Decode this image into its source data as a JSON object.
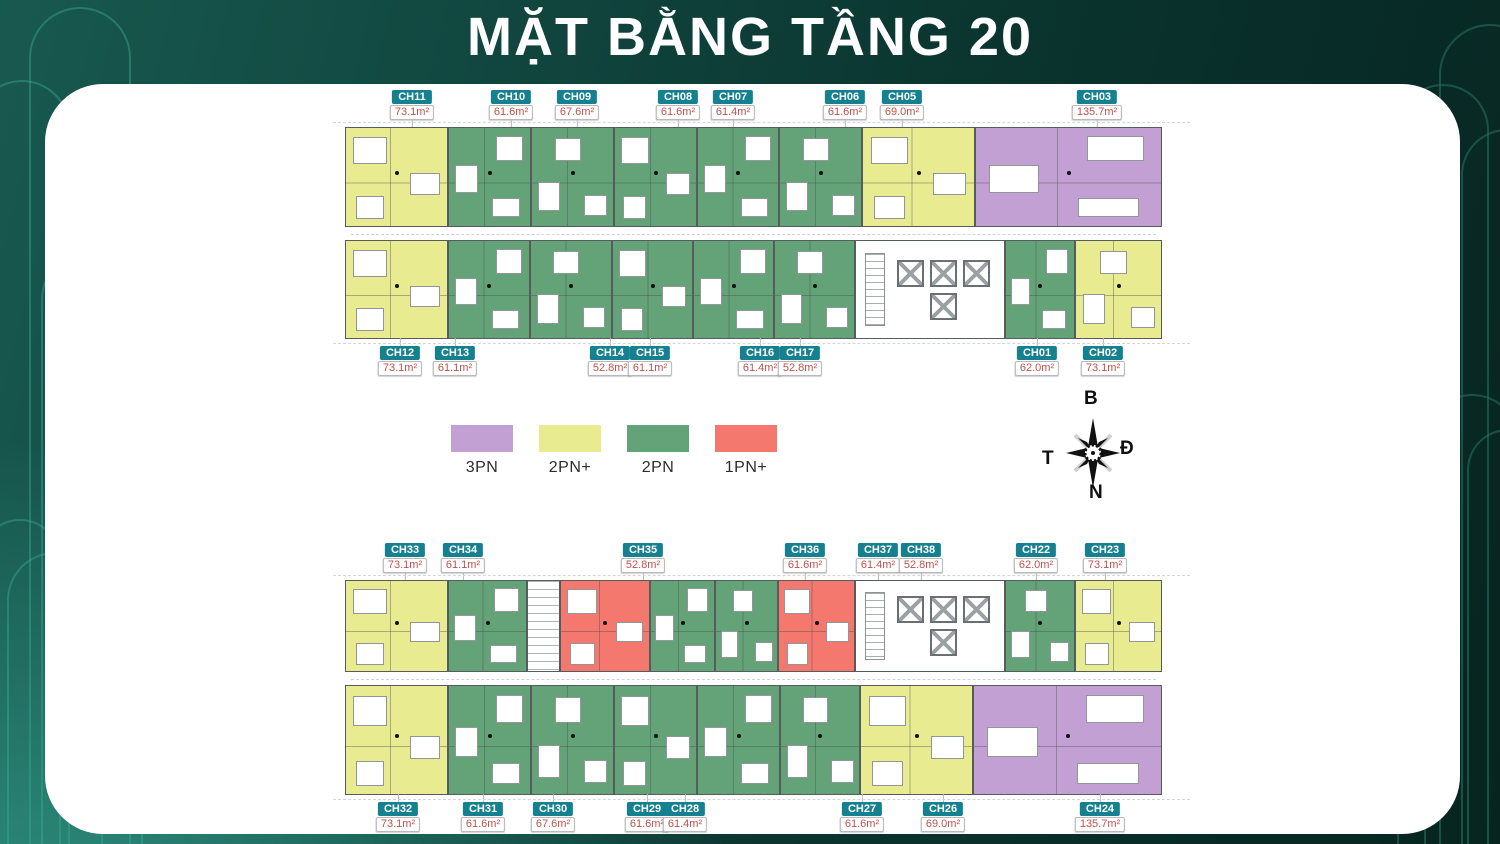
{
  "title": "MẶT BẰNG TẦNG 20",
  "legend": {
    "items": [
      {
        "label": "3PN",
        "type": "3PN"
      },
      {
        "label": "2PN+",
        "type": "2PN+"
      },
      {
        "label": "2PN",
        "type": "2PN"
      },
      {
        "label": "1PN+",
        "type": "1PN+"
      }
    ]
  },
  "compass": {
    "north_label": "B",
    "east_label": "Đ",
    "south_label": "N",
    "west_label": "T"
  },
  "unit_types": {
    "3PN": "#c3a0d4",
    "2PN+": "#e9eb90",
    "2PN": "#63a377",
    "1PN+": "#f5786e"
  },
  "plans": [
    {
      "name": "top-wing",
      "left": 345,
      "top": 88,
      "width": 817,
      "label_zone_h": 39,
      "row_heights": [
        100,
        99
      ],
      "corridor_h": 13,
      "labels_above": [
        {
          "id": "CH11",
          "area": "73.1m²",
          "x": 412
        },
        {
          "id": "CH10",
          "area": "61.6m²",
          "x": 511
        },
        {
          "id": "CH09",
          "area": "67.6m²",
          "x": 577
        },
        {
          "id": "CH08",
          "area": "61.6m²",
          "x": 678
        },
        {
          "id": "CH07",
          "area": "61.4m²",
          "x": 733
        },
        {
          "id": "CH06",
          "area": "61.6m²",
          "x": 845
        },
        {
          "id": "CH05",
          "area": "69.0m²",
          "x": 902
        },
        {
          "id": "CH03",
          "area": "135.7m²",
          "x": 1097
        }
      ],
      "labels_below": [
        {
          "id": "CH12",
          "area": "73.1m²",
          "x": 400
        },
        {
          "id": "CH13",
          "area": "61.1m²",
          "x": 455
        },
        {
          "id": "CH14",
          "area": "52.8m²",
          "x": 610
        },
        {
          "id": "CH15",
          "area": "61.1m²",
          "x": 650
        },
        {
          "id": "CH16",
          "area": "61.4m²",
          "x": 760
        },
        {
          "id": "CH17",
          "area": "52.8m²",
          "x": 800
        },
        {
          "id": "CH01",
          "area": "62.0m²",
          "x": 1037
        },
        {
          "id": "CH02",
          "area": "73.1m²",
          "x": 1103
        }
      ],
      "rows": [
        [
          {
            "id": "CH11",
            "type": "2PN+",
            "w": 103
          },
          {
            "id": "CH10",
            "type": "2PN",
            "w": 83
          },
          {
            "id": "CH09",
            "type": "2PN",
            "w": 83
          },
          {
            "id": "CH08",
            "type": "2PN",
            "w": 83
          },
          {
            "id": "CH07",
            "type": "2PN",
            "w": 82
          },
          {
            "id": "CH06",
            "type": "2PN",
            "w": 83
          },
          {
            "id": "CH05",
            "type": "2PN+",
            "w": 113
          },
          {
            "id": "CH03",
            "type": "3PN",
            "w": 187
          }
        ],
        [
          {
            "id": "CH12",
            "type": "2PN+",
            "w": 103
          },
          {
            "id": "CH13",
            "type": "2PN",
            "w": 82
          },
          {
            "id": "CH14",
            "type": "2PN",
            "w": 82
          },
          {
            "id": "CH15",
            "type": "2PN",
            "w": 81
          },
          {
            "id": "CH16",
            "type": "2PN",
            "w": 81
          },
          {
            "id": "CH17",
            "type": "2PN",
            "w": 81
          },
          {
            "id": "",
            "type": "core",
            "w": 150
          },
          {
            "id": "CH01",
            "type": "2PN",
            "w": 70
          },
          {
            "id": "CH02",
            "type": "2PN+",
            "w": 87
          }
        ]
      ]
    },
    {
      "name": "bottom-wing",
      "left": 345,
      "top": 543,
      "width": 817,
      "label_zone_h": 37,
      "row_heights": [
        92,
        110
      ],
      "corridor_h": 13,
      "labels_above": [
        {
          "id": "CH33",
          "area": "73.1m²",
          "x": 405
        },
        {
          "id": "CH34",
          "area": "61.1m²",
          "x": 463
        },
        {
          "id": "CH35",
          "area": "52.8m²",
          "x": 643
        },
        {
          "id": "CH36",
          "area": "61.6m²",
          "x": 805
        },
        {
          "id": "CH37",
          "area": "61.4m²",
          "x": 878
        },
        {
          "id": "CH38",
          "area": "52.8m²",
          "x": 921
        },
        {
          "id": "CH22",
          "area": "62.0m²",
          "x": 1036
        },
        {
          "id": "CH23",
          "area": "73.1m²",
          "x": 1105
        }
      ],
      "labels_below": [
        {
          "id": "CH32",
          "area": "73.1m²",
          "x": 398
        },
        {
          "id": "CH31",
          "area": "61.6m²",
          "x": 483
        },
        {
          "id": "CH30",
          "area": "67.6m²",
          "x": 553
        },
        {
          "id": "CH29",
          "area": "61.6m²",
          "x": 647
        },
        {
          "id": "CH28",
          "area": "61.4m²",
          "x": 685
        },
        {
          "id": "CH27",
          "area": "61.6m²",
          "x": 862
        },
        {
          "id": "CH26",
          "area": "69.0m²",
          "x": 943
        },
        {
          "id": "CH24",
          "area": "135.7m²",
          "x": 1100
        }
      ],
      "rows": [
        [
          {
            "id": "CH33",
            "type": "2PN+",
            "w": 103
          },
          {
            "id": "CH34",
            "type": "2PN",
            "w": 79
          },
          {
            "id": "",
            "type": "stair",
            "w": 33
          },
          {
            "id": "CH35",
            "type": "1PN+",
            "w": 90
          },
          {
            "id": "CH36",
            "type": "2PN",
            "w": 65
          },
          {
            "id": "CH37",
            "type": "2PN",
            "w": 63
          },
          {
            "id": "CH38",
            "type": "1PN+",
            "w": 77
          },
          {
            "id": "",
            "type": "core",
            "w": 150
          },
          {
            "id": "CH22",
            "type": "2PN",
            "w": 70
          },
          {
            "id": "CH23",
            "type": "2PN+",
            "w": 87
          }
        ],
        [
          {
            "id": "CH32",
            "type": "2PN+",
            "w": 103
          },
          {
            "id": "CH31",
            "type": "2PN",
            "w": 83
          },
          {
            "id": "CH30",
            "type": "2PN",
            "w": 83
          },
          {
            "id": "CH29",
            "type": "2PN",
            "w": 83
          },
          {
            "id": "CH28",
            "type": "2PN",
            "w": 83
          },
          {
            "id": "CH27",
            "type": "2PN",
            "w": 80
          },
          {
            "id": "CH26",
            "type": "2PN+",
            "w": 113
          },
          {
            "id": "CH24",
            "type": "3PN",
            "w": 189
          }
        ]
      ]
    }
  ]
}
